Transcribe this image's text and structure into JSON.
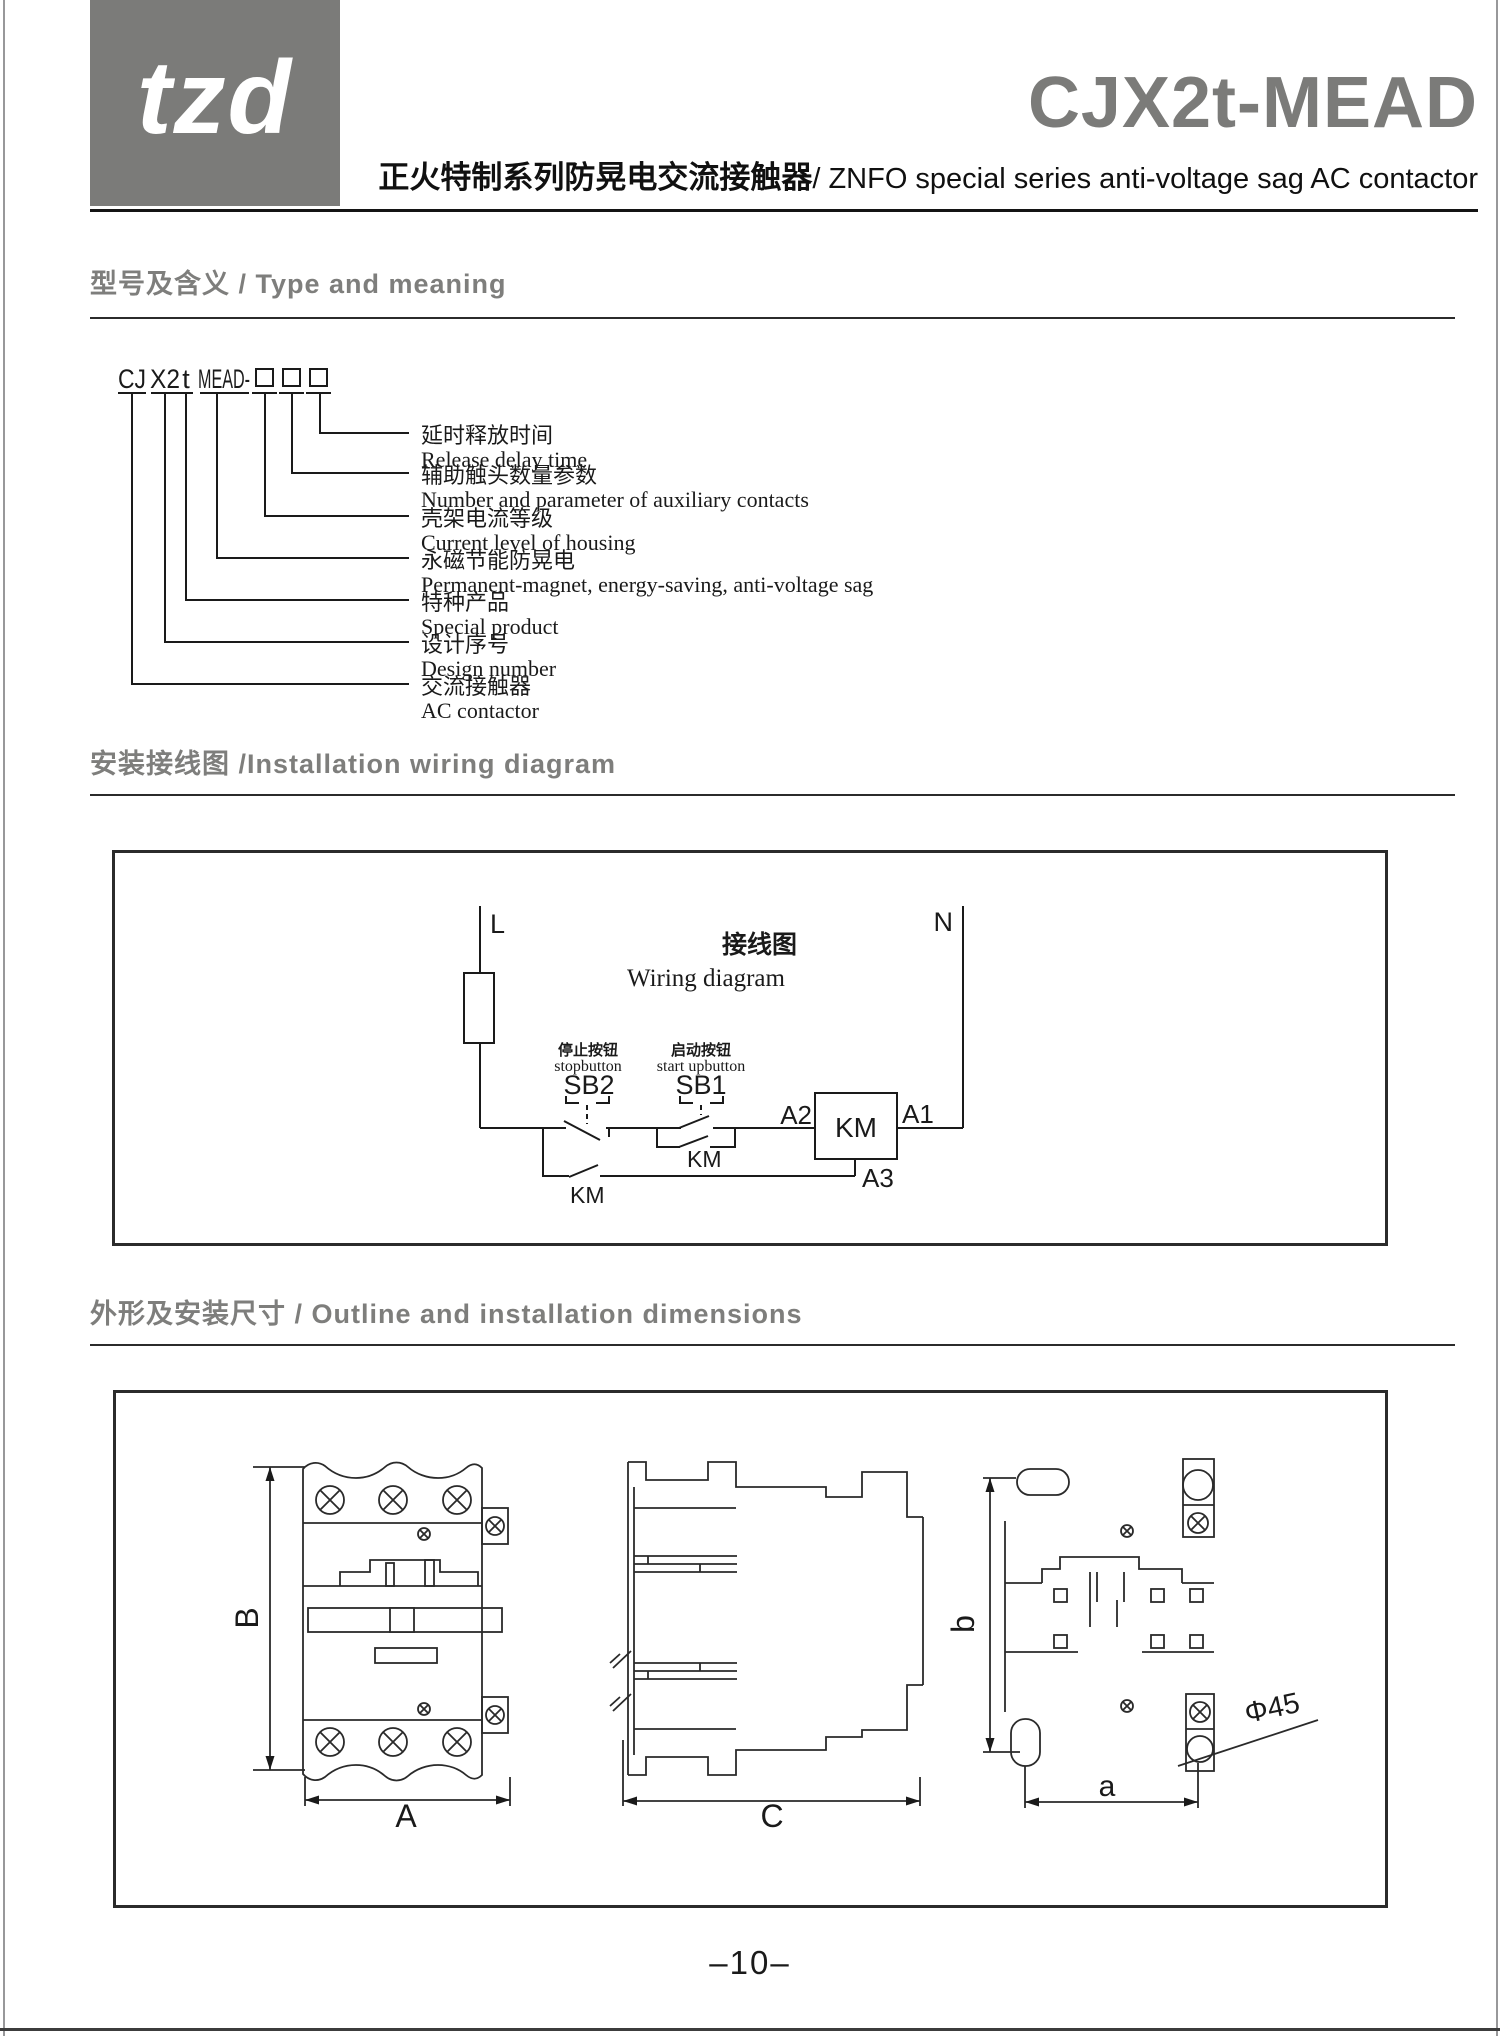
{
  "header": {
    "logo_text": "tzd",
    "product_model": "CJX2t-MEAD",
    "subtitle_zh": "正火特制系列防晃电交流接触器",
    "subtitle_en": "/ ZNFO special series anti-voltage sag AC contactor"
  },
  "sections": {
    "type_meaning_heading": "型号及含义 / Type and meaning",
    "wiring_heading": "安装接线图 /Installation wiring diagram",
    "outline_heading": "外形及安装尺寸 / Outline and installation dimensions"
  },
  "type_diagram": {
    "model_prefix": "CJ",
    "design_code": "X2",
    "special_code": "t",
    "series_code": "MEAD-",
    "labels": [
      {
        "zh": "延时释放时间",
        "en": "Release delay time"
      },
      {
        "zh": "辅助触头数量参数",
        "en": "Number and parameter of auxiliary contacts"
      },
      {
        "zh": "壳架电流等级",
        "en": "Current level of housing"
      },
      {
        "zh": "永磁节能防晃电",
        "en": "Permanent-magnet, energy-saving, anti-voltage sag"
      },
      {
        "zh": "特种产品",
        "en": "Special product"
      },
      {
        "zh": "设计序号",
        "en": "Design number"
      },
      {
        "zh": "交流接触器",
        "en": "AC contactor"
      }
    ]
  },
  "wiring_diagram": {
    "title_zh": "接线图",
    "title_en": "Wiring diagram",
    "line_label": "L",
    "neutral_label": "N",
    "stop_button_zh": "停止按钮",
    "stop_button_en": "stopbutton",
    "stop_button_ref": "SB2",
    "start_button_zh": "启动按钮",
    "start_button_en": "start upbutton",
    "start_button_ref": "SB1",
    "aux_contact_ref": "KM",
    "seal_in_contact_ref": "KM",
    "coil_ref": "KM",
    "terminal_a1": "A1",
    "terminal_a2": "A2",
    "terminal_a3": "A3"
  },
  "outline": {
    "dim_height": "B",
    "dim_width": "A",
    "dim_depth": "C",
    "dim_hole_spacing_h": "a",
    "dim_hole_spacing_v": "b",
    "dim_hole_dia": "Φ45"
  },
  "footer": {
    "page_number": "–10–"
  },
  "colors": {
    "brand_gray": "#7b7b79",
    "heading_gray": "#7e7e7c",
    "line_color": "#1a1a1a"
  }
}
